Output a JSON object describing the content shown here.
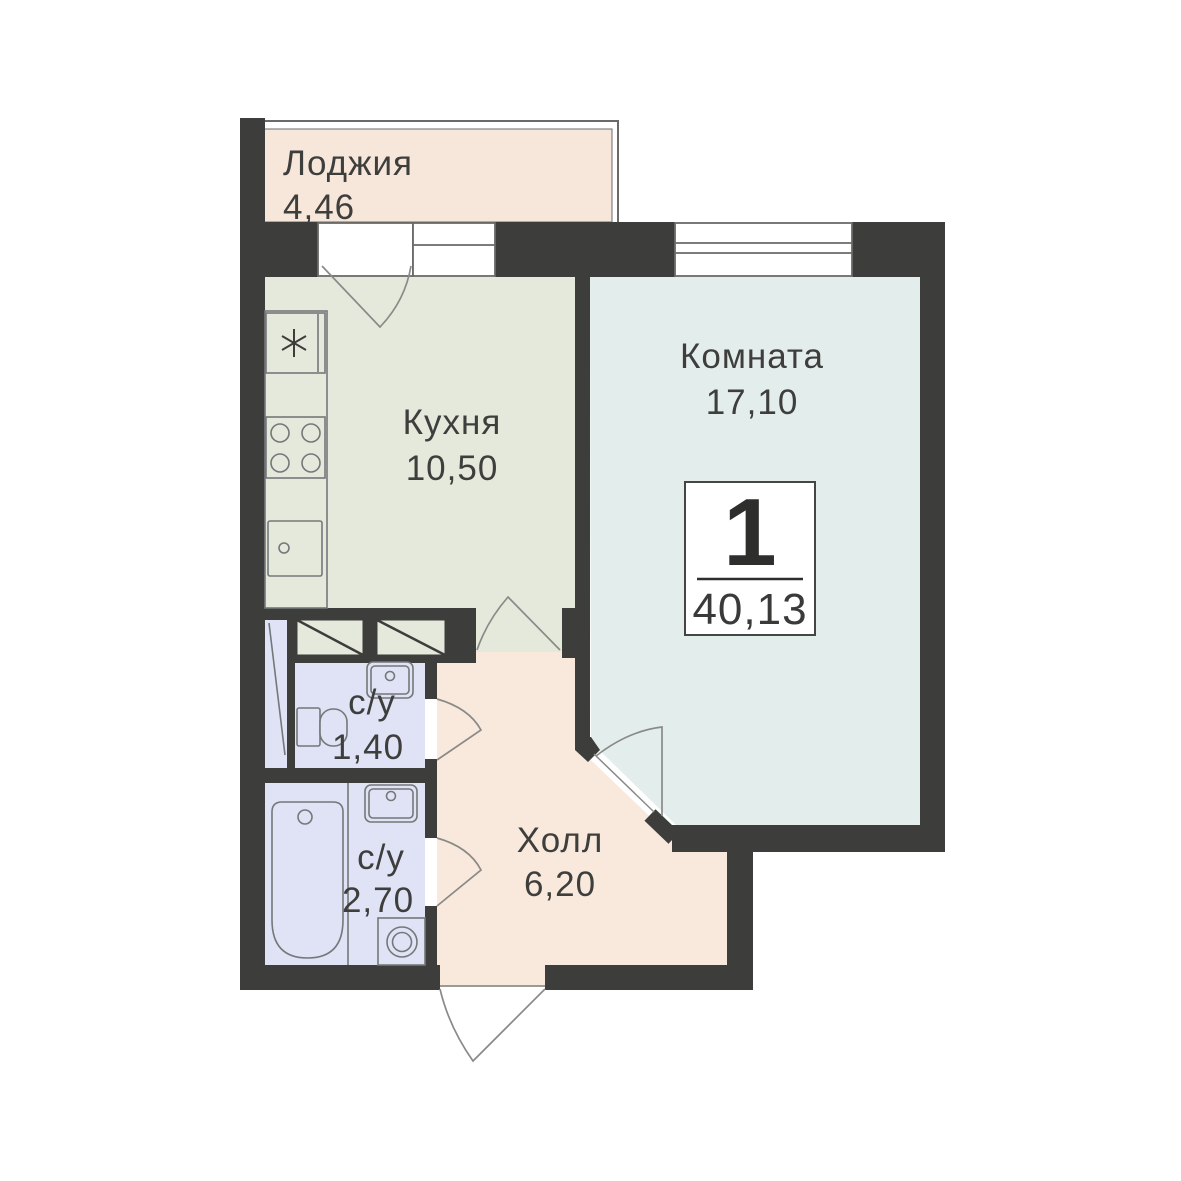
{
  "plan": {
    "title": "Floor plan of 1-room apartment",
    "badge": {
      "rooms_count": "1",
      "total_area": "40,13"
    },
    "rooms": {
      "loggia": {
        "label": "Лоджия",
        "area": "4,46"
      },
      "kitchen": {
        "label": "Кухня",
        "area": "10,50"
      },
      "living": {
        "label": "Комната",
        "area": "17,10"
      },
      "wc_small": {
        "label": "с/у",
        "area": "1,40"
      },
      "wc_big": {
        "label": "с/у",
        "area": "2,70"
      },
      "hall": {
        "label": "Холл",
        "area": "6,20"
      }
    }
  },
  "colors": {
    "wall": "#3d3d3b",
    "loggia": "#f7e7da",
    "kitchen": "#e4e9db",
    "room": "#e3eeec",
    "bath": "#dfe3f5",
    "hall": "#f8e9dc",
    "fixture": "#74787a",
    "door": "#8a8a88",
    "frame": "#6a6a68",
    "text": "#3e3e3c"
  }
}
